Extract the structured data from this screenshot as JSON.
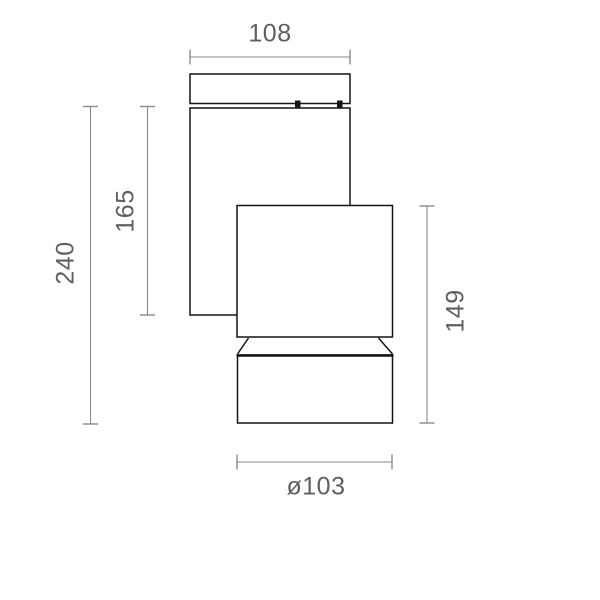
{
  "meta": {
    "drawing_type": "luminaire dimension diagram",
    "units_shown": "mm (implied)"
  },
  "colors": {
    "background": "#ffffff",
    "outline": "#141414",
    "dimension_line": "#8a8a8a",
    "dimension_text": "#5f5f5f"
  },
  "fixture_parts": {
    "cap": "top mounting cap",
    "body": "wall-mount body",
    "head": "lamp head box",
    "shade": "cylindrical shade"
  },
  "dimensions": {
    "cap_width": "108",
    "body_height": "165",
    "overall_height": "240",
    "head_assembly_height": "149",
    "shade_diameter": "ø103"
  }
}
